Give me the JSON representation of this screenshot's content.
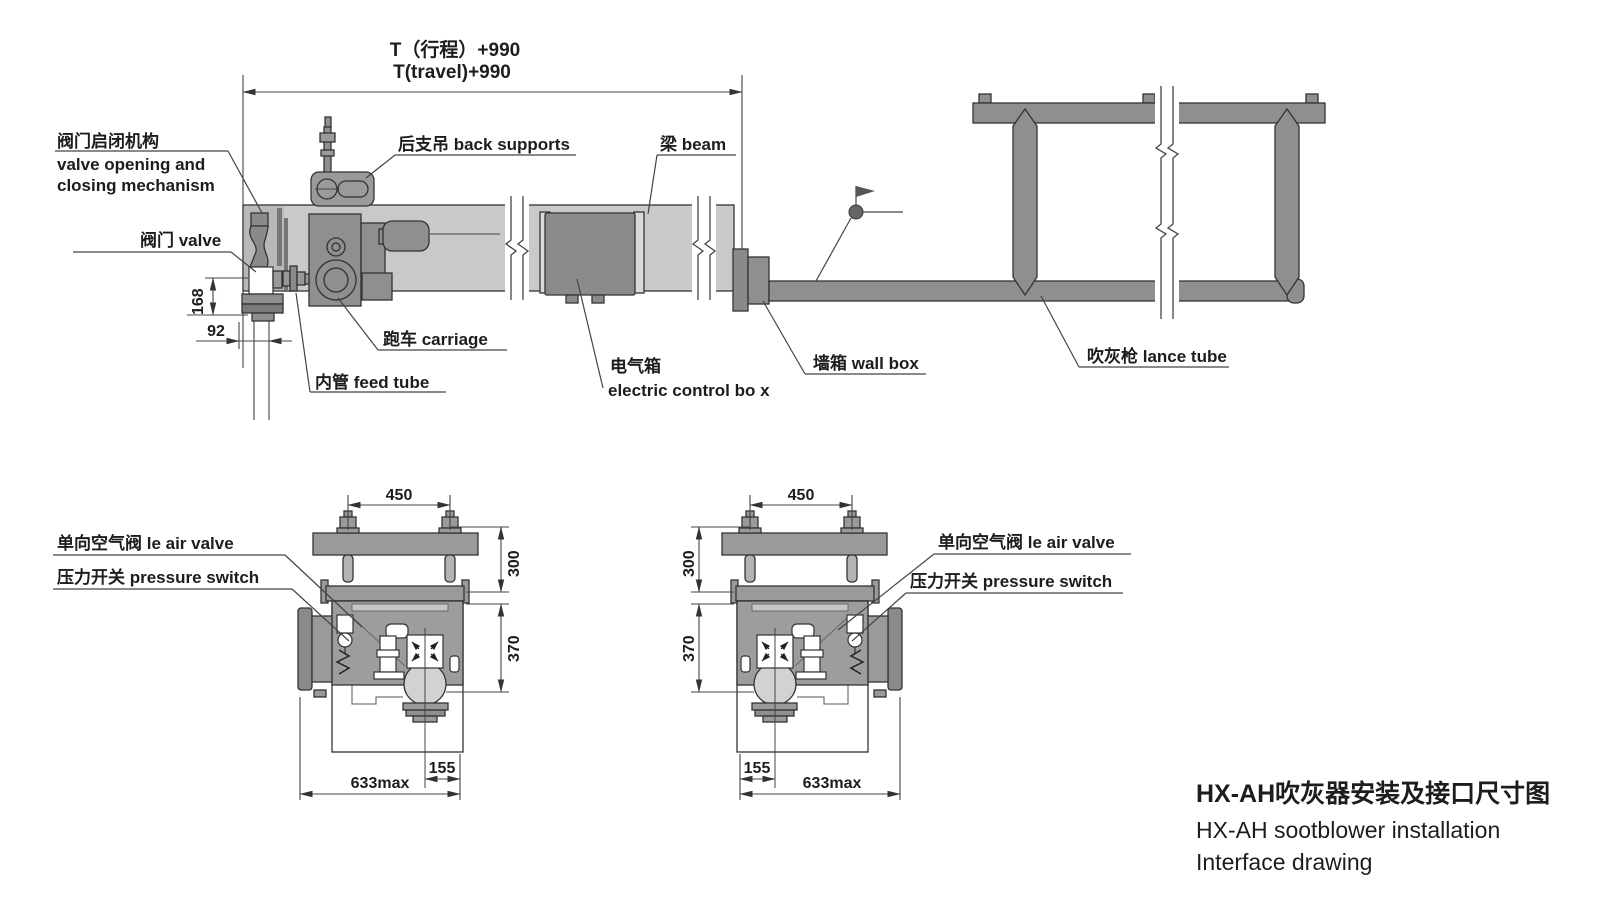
{
  "title_block": {
    "line1_zh": "HX-AH吹灰器安装及接口尺寸图",
    "line2_en": "HX-AH sootblower installation",
    "line3_en": "Interface drawing"
  },
  "main_view": {
    "travel_dim": {
      "zh": "T（行程）+990",
      "en": "T(travel)+990"
    },
    "labels": {
      "valve_mechanism": {
        "zh": "阀门启闭机构",
        "en1": "valve opening and",
        "en2": "closing mechanism"
      },
      "valve": "阀门 valve",
      "back_supports": "后支吊 back supports",
      "beam": "梁 beam",
      "carriage": "跑车 carriage",
      "feed_tube": "内管 feed tube",
      "electric_box": {
        "zh": "电气箱",
        "en": "electric control bo x"
      },
      "wall_box": "墙箱 wall box",
      "lance_tube": "吹灰枪 lance tube"
    },
    "dims": {
      "valve_height": "168",
      "feed_tube_offset": "92"
    }
  },
  "section_views": {
    "labels": {
      "air_valve": "单向空气阀 le air valve",
      "pressure_switch": "压力开关 pressure switch"
    },
    "dims": {
      "bolt_spacing": "450",
      "plate_to_rail": "300",
      "rail_to_center": "370",
      "center_offset": "155",
      "overall_width": "633max"
    }
  },
  "colors": {
    "background": "#ffffff",
    "beam": "#c9c9c9",
    "machine": "#9a9a9a",
    "dark_panel": "#8b8b8b",
    "steel": "#8f8f8f",
    "line": "#333333"
  }
}
